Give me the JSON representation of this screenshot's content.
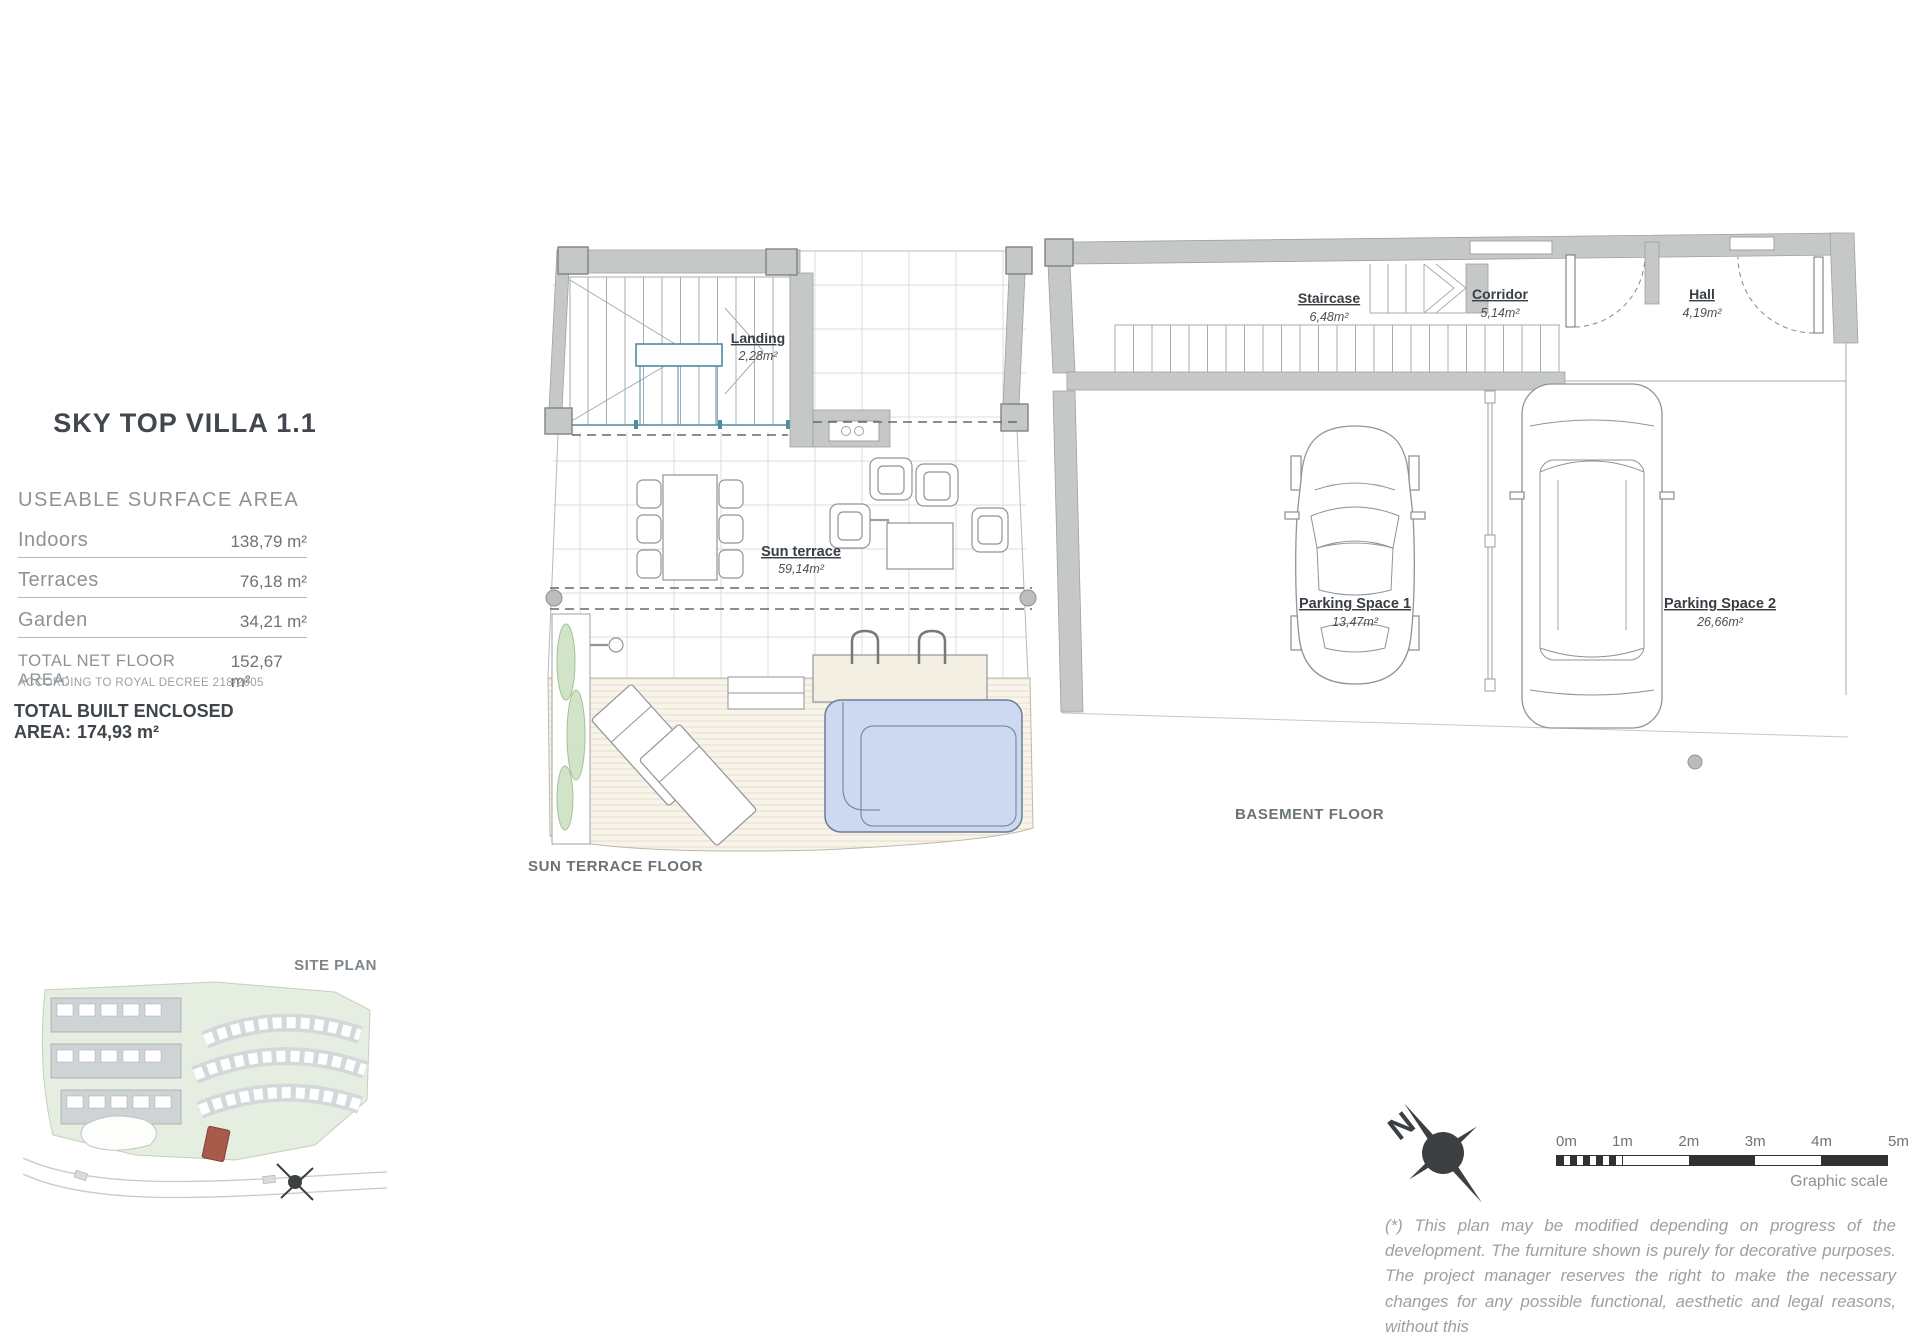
{
  "info_panel": {
    "title": "SKY TOP VILLA 1.1",
    "section_header": "USEABLE SURFACE AREA",
    "rows": [
      {
        "label": "Indoors",
        "value": "138,79 m²"
      },
      {
        "label": "Terraces",
        "value": "76,18 m²"
      },
      {
        "label": "Garden",
        "value": "34,21 m²"
      }
    ],
    "total_net_label": "TOTAL NET FLOOR AREA:",
    "total_net_value": "152,67 m²",
    "total_net_note": "ACCORDING TO ROYAL DECREE 218/2005",
    "total_built_label": "TOTAL BUILT ENCLOSED AREA:",
    "total_built_value": "174,93 m²"
  },
  "sun_terrace": {
    "caption": "SUN TERRACE FLOOR",
    "rooms": [
      {
        "name": "Landing",
        "area": "2,28m²"
      },
      {
        "name": "Sun terrace",
        "area": "59,14m²"
      }
    ]
  },
  "basement": {
    "caption": "BASEMENT FLOOR",
    "rooms": [
      {
        "name": "Staircase",
        "area": "6,48m²"
      },
      {
        "name": "Corridor",
        "area": "5,14m²"
      },
      {
        "name": "Hall",
        "area": "4,19m²"
      },
      {
        "name": "Parking Space 1",
        "area": "13,47m²"
      },
      {
        "name": "Parking Space 2",
        "area": "26,66m²"
      }
    ]
  },
  "site_plan": {
    "caption": "SITE PLAN"
  },
  "north": {
    "label": "N"
  },
  "scale_bar": {
    "ticks": [
      "0m",
      "1m",
      "2m",
      "3m",
      "4m",
      "5m"
    ],
    "caption": "Graphic scale"
  },
  "disclaimer": "(*) This plan may be modified depending on progress of the development. The furniture shown is purely for decorative purposes. The project manager reserves the right to make the necessary changes for any possible functional, aesthetic and legal reasons, without this"
}
